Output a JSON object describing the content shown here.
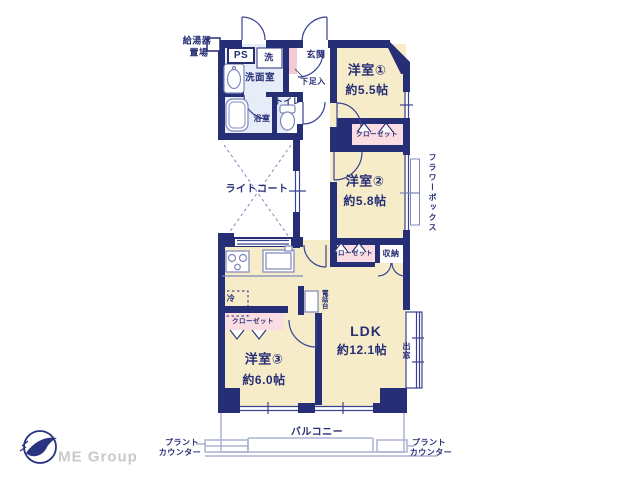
{
  "colors": {
    "wall": "#262e75",
    "room_cream": "#f7ecca",
    "closet_pink": "#fadce3",
    "wet_blue": "#e6ecf8",
    "step_pink": "#f3c9d3",
    "line_light": "#aab3d4",
    "logo_gray": "#c9c9c9"
  },
  "plan": {
    "rooms": {
      "western1": {
        "name": "洋室①",
        "size": "約5.5帖"
      },
      "western2": {
        "name": "洋室②",
        "size": "約5.8帖"
      },
      "western3": {
        "name": "洋室③",
        "size": "約6.0帖"
      },
      "ldk": {
        "name": "LDK",
        "size": "約12.1帖"
      },
      "entrance": "玄関",
      "washroom": "洗面室",
      "bathroom": "浴室",
      "toilet": "トイレ",
      "pipe_space": "PS",
      "laundry": "洗",
      "light_court": "ライトコート",
      "balcony": "バルコニー"
    },
    "storage": {
      "closet": "クローゼット",
      "storage": "収納",
      "shoe_box": "下足入"
    },
    "features": {
      "water_heater_line1": "給湯器",
      "water_heater_line2": "置場",
      "refrigerator": "冷",
      "phone_stand": "電話台",
      "bay_window": "出窓",
      "flower_box": "フラワーボックス",
      "plant_counter_line1": "プラント",
      "plant_counter_line2": "カウンター"
    }
  },
  "branding": {
    "logo_text": "ME Group"
  }
}
